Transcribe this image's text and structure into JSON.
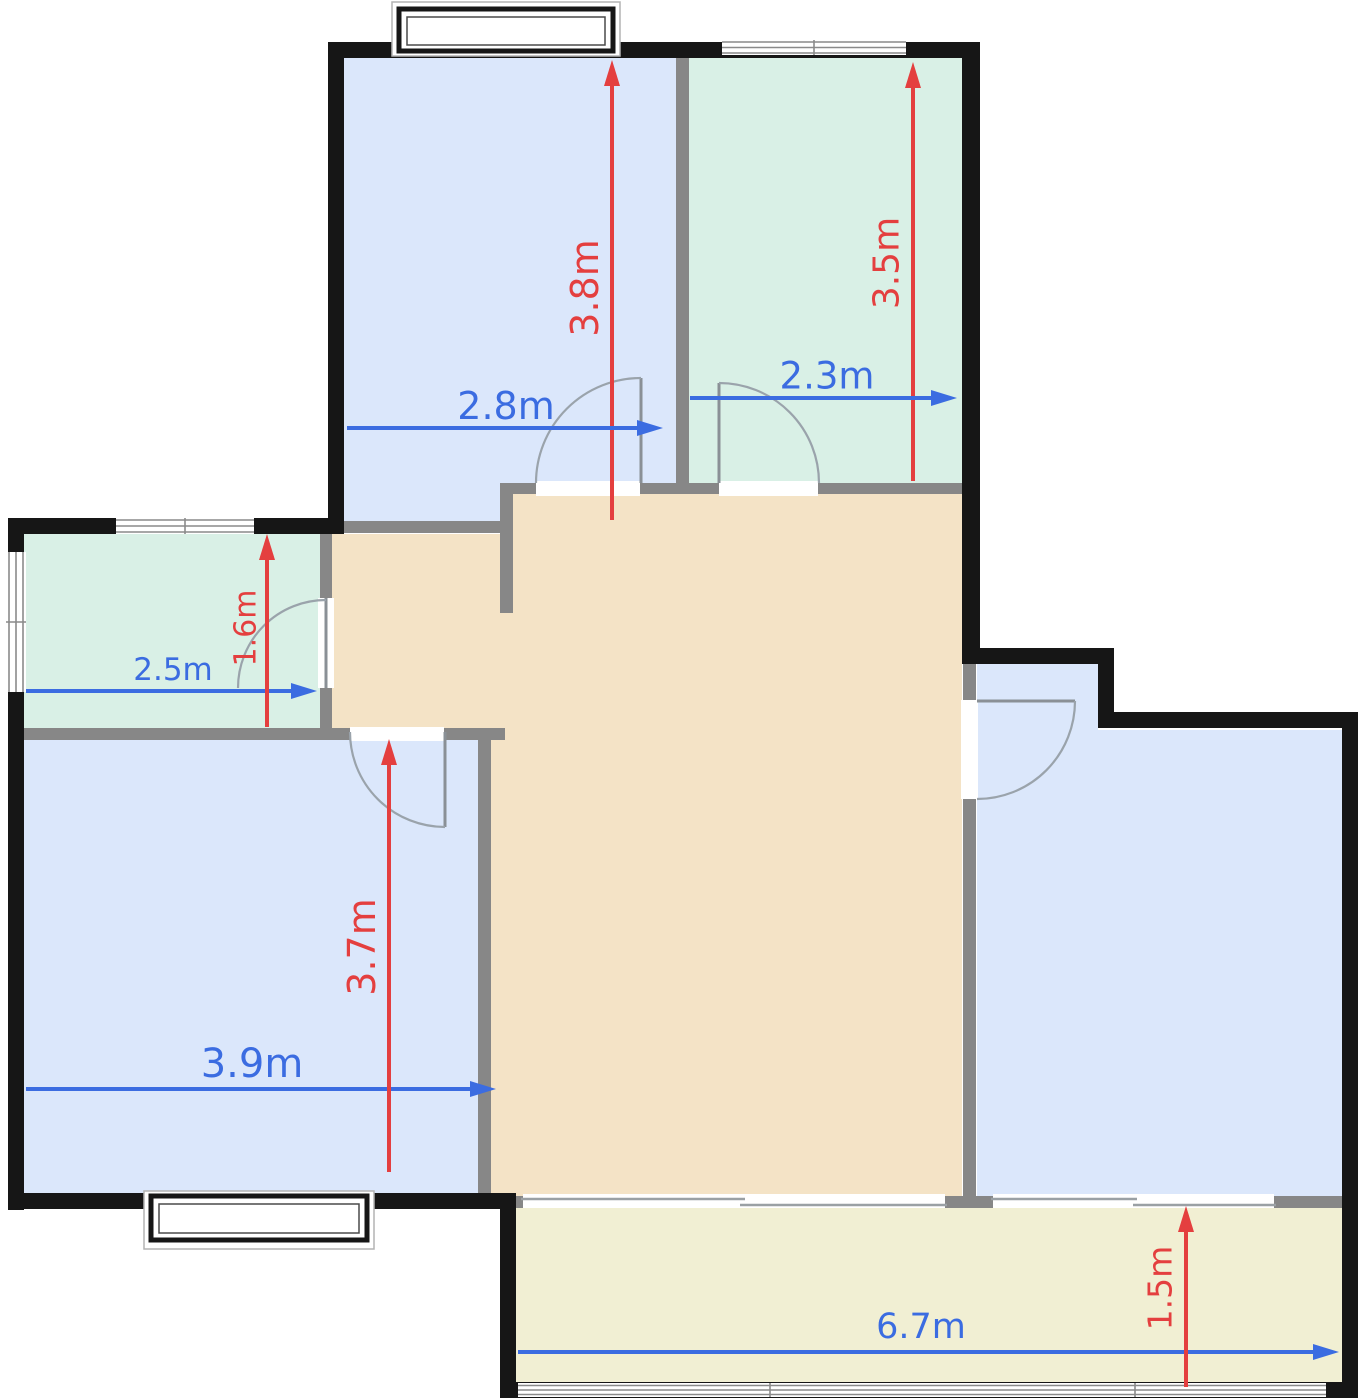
{
  "floorplan": {
    "canvas": {
      "width": 1361,
      "height": 1400
    },
    "colors": {
      "room_blue": "#dbe7fb",
      "room_green": "#d9f0e6",
      "hall_tan": "#f4e3c6",
      "balcony_yellow": "#f1efd3",
      "wall_exterior": "#161616",
      "wall_interior": "#878787",
      "dim_red": "#e43f3f",
      "dim_blue": "#3b6ce1",
      "door_arc": "#9aa3ab",
      "window_line": "#8a8a8a",
      "outside": "#ffffff"
    },
    "rooms": [
      {
        "id": "room-top-left",
        "fill": "room_blue",
        "width_label": "2.8m",
        "height_label": "3.8m"
      },
      {
        "id": "room-top-right",
        "fill": "room_green",
        "width_label": "2.3m",
        "height_label": "3.5m"
      },
      {
        "id": "room-mid-left",
        "fill": "room_green",
        "width_label": "2.5m",
        "height_label": "1.6m"
      },
      {
        "id": "room-bottom-left",
        "fill": "room_blue",
        "width_label": "3.9m",
        "height_label": "3.7m"
      },
      {
        "id": "hall-center",
        "fill": "hall_tan"
      },
      {
        "id": "room-right",
        "fill": "room_blue"
      },
      {
        "id": "balcony-bottom",
        "fill": "balcony_yellow",
        "width_label": "6.7m",
        "height_label": "1.5m"
      }
    ],
    "dimensions": [
      {
        "label": "3.8m",
        "axis": "v",
        "color": "dim_red",
        "x": 612,
        "y_from": 520,
        "y_to": 60,
        "label_x": 585,
        "label_y": 288,
        "size": 38
      },
      {
        "label": "3.5m",
        "axis": "v",
        "color": "dim_red",
        "x": 913,
        "y_from": 481,
        "y_to": 62,
        "label_x": 887,
        "label_y": 263,
        "size": 36
      },
      {
        "label": "2.8m",
        "axis": "h",
        "color": "dim_blue",
        "y": 428,
        "x_from": 347,
        "x_to": 663,
        "label_x": 506,
        "label_y": 406,
        "size": 38
      },
      {
        "label": "2.3m",
        "axis": "h",
        "color": "dim_blue",
        "y": 398,
        "x_from": 690,
        "x_to": 957,
        "label_x": 827,
        "label_y": 376,
        "size": 37
      },
      {
        "label": "2.5m",
        "axis": "h",
        "color": "dim_blue",
        "y": 691,
        "x_from": 26,
        "x_to": 317,
        "label_x": 173,
        "label_y": 670,
        "size": 31
      },
      {
        "label": "1.6m",
        "axis": "v",
        "color": "dim_red",
        "x": 267,
        "y_from": 727,
        "y_to": 534,
        "label_x": 246,
        "label_y": 628,
        "size": 30
      },
      {
        "label": "3.9m",
        "axis": "h",
        "color": "dim_blue",
        "y": 1089,
        "x_from": 26,
        "x_to": 496,
        "label_x": 252,
        "label_y": 1064,
        "size": 40
      },
      {
        "label": "3.7m",
        "axis": "v",
        "color": "dim_red",
        "x": 389,
        "y_from": 1172,
        "y_to": 739,
        "label_x": 362,
        "label_y": 947,
        "size": 38
      },
      {
        "label": "6.7m",
        "axis": "h",
        "color": "dim_blue",
        "y": 1352,
        "x_from": 518,
        "x_to": 1339,
        "label_x": 921,
        "label_y": 1327,
        "size": 35
      },
      {
        "label": "1.5m",
        "axis": "v",
        "color": "dim_red",
        "x": 1186,
        "y_from": 1387,
        "y_to": 1206,
        "label_x": 1160,
        "label_y": 1288,
        "size": 33
      }
    ]
  }
}
